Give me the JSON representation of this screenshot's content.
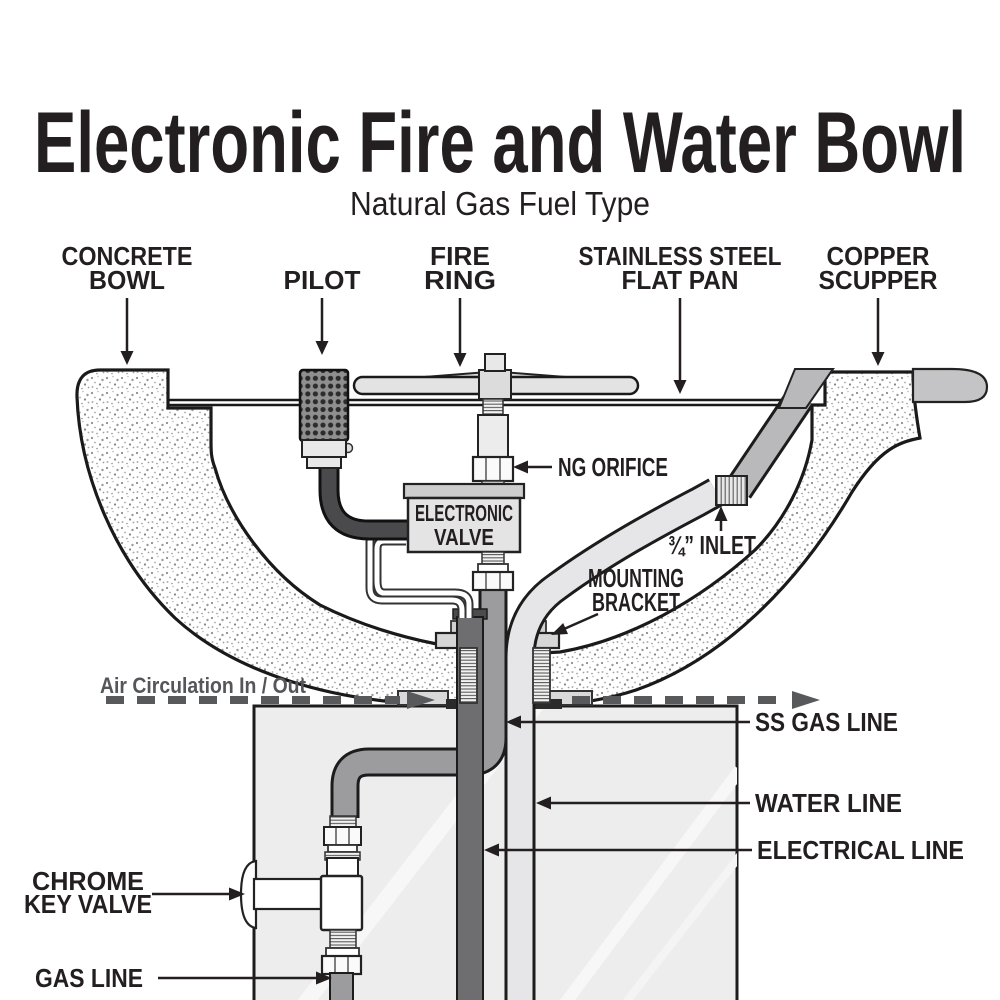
{
  "title": "Electronic Fire and Water Bowl",
  "subtitle": "Natural Gas Fuel Type",
  "labels": {
    "concrete_bowl": {
      "line1": "CONCRETE",
      "line2": "BOWL"
    },
    "pilot": "PILOT",
    "fire_ring": {
      "line1": "FIRE",
      "line2": "RING"
    },
    "flat_pan": {
      "line1": "STAINLESS STEEL",
      "line2": "FLAT PAN"
    },
    "copper_scupper": {
      "line1": "COPPER",
      "line2": "SCUPPER"
    },
    "ng_orifice": "NG ORIFICE",
    "inlet": "¾” INLET",
    "mounting_bracket": {
      "line1": "MOUNTING",
      "line2": "BRACKET"
    },
    "air_circulation": "Air Circulation In / Out",
    "ss_gas_line": "SS GAS LINE",
    "water_line": "WATER LINE",
    "electrical_line": "ELECTRICAL  LINE",
    "chrome_key_valve": {
      "line1": "CHROME",
      "line2": "KEY VALVE"
    },
    "gas_line": "GAS LINE",
    "electronic_valve": {
      "line1": "ELECTRONIC",
      "line2": "VALVE"
    }
  },
  "colors": {
    "label_text": "#231f20",
    "air_circulation_gray": "#55565a",
    "diagram_stroke": "#1a1a1a",
    "copper_pipe_gray": "#b9b9bb",
    "gas_pipe_gray": "#9c9c9e",
    "electrical_conduit_gray": "#6e6e70",
    "water_pipe_gray": "#e6e6e8",
    "pedestal_fill": "#ededed",
    "scupper_gray": "#c4c4c6"
  }
}
